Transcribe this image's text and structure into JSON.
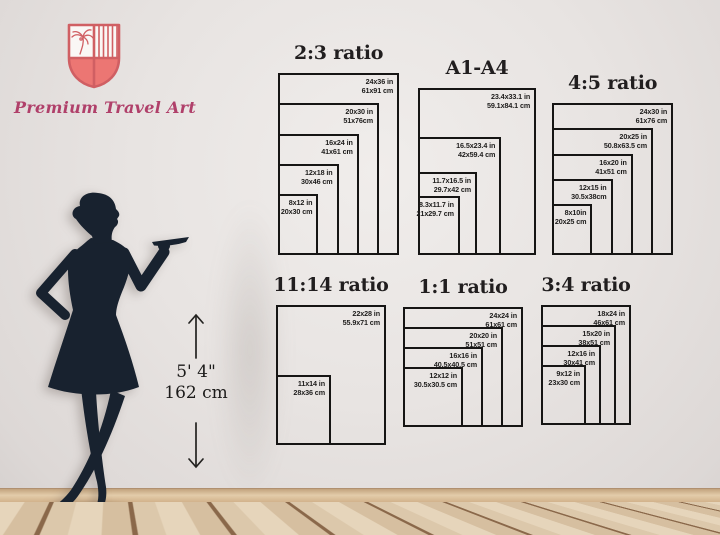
{
  "brand": {
    "name": "Premium Travel Art"
  },
  "height_marker": {
    "imperial": "5' 4\"",
    "metric": "162 cm"
  },
  "colors": {
    "shield_outline": "#d05f63",
    "shield_fill": "#ec7673",
    "brand_text": "#b0406a",
    "silhouette": "#18222f",
    "box_line": "#161514",
    "label_text": "#1d1c1b"
  },
  "charts": [
    {
      "id": "ratio-2-3",
      "title": "2:3 ratio",
      "sizes": [
        {
          "inches": "24x36 in",
          "cm": "61x91 cm",
          "w": 24,
          "h": 36
        },
        {
          "inches": "20x30 in",
          "cm": "51x76cm",
          "w": 20,
          "h": 30
        },
        {
          "inches": "16x24 in",
          "cm": "41x61 cm",
          "w": 16,
          "h": 24
        },
        {
          "inches": "12x18 in",
          "cm": "30x46 cm",
          "w": 12,
          "h": 18
        },
        {
          "inches": "8x12 in",
          "cm": "20x30 cm",
          "w": 8,
          "h": 12
        }
      ]
    },
    {
      "id": "a1-a4",
      "title": "A1-A4",
      "sizes": [
        {
          "inches": "23.4x33.1 in",
          "cm": "59.1x84.1 cm",
          "w": 23.4,
          "h": 33.1
        },
        {
          "inches": "16.5x23.4 in",
          "cm": "42x59.4 cm",
          "w": 16.5,
          "h": 23.4
        },
        {
          "inches": "11.7x16.5 in",
          "cm": "29.7x42 cm",
          "w": 11.7,
          "h": 16.5
        },
        {
          "inches": "8.3x11.7 in",
          "cm": "21x29.7 cm",
          "w": 8.3,
          "h": 11.7
        }
      ]
    },
    {
      "id": "ratio-4-5",
      "title": "4:5 ratio",
      "sizes": [
        {
          "inches": "24x30 in",
          "cm": "61x76 cm",
          "w": 24,
          "h": 30
        },
        {
          "inches": "20x25 in",
          "cm": "50.8x63.5 cm",
          "w": 20,
          "h": 25
        },
        {
          "inches": "16x20 in",
          "cm": "41x51 cm",
          "w": 16,
          "h": 20
        },
        {
          "inches": "12x15 in",
          "cm": "30.5x38cm",
          "w": 12,
          "h": 15
        },
        {
          "inches": "8x10in",
          "cm": "20x25 cm",
          "w": 8,
          "h": 10
        }
      ]
    },
    {
      "id": "ratio-11-14",
      "title": "11:14 ratio",
      "sizes": [
        {
          "inches": "22x28 in",
          "cm": "55.9x71 cm",
          "w": 22,
          "h": 28
        },
        {
          "inches": "11x14 in",
          "cm": "28x36 cm",
          "w": 11,
          "h": 14
        }
      ]
    },
    {
      "id": "ratio-1-1",
      "title": "1:1 ratio",
      "sizes": [
        {
          "inches": "24x24 in",
          "cm": "61x61 cm",
          "w": 24,
          "h": 24
        },
        {
          "inches": "20x20 in",
          "cm": "51x51 cm",
          "w": 20,
          "h": 20
        },
        {
          "inches": "16x16 in",
          "cm": "40.5x40.5 cm",
          "w": 16,
          "h": 16
        },
        {
          "inches": "12x12 in",
          "cm": "30.5x30.5 cm",
          "w": 12,
          "h": 12
        }
      ]
    },
    {
      "id": "ratio-3-4",
      "title": "3:4 ratio",
      "sizes": [
        {
          "inches": "18x24 in",
          "cm": "46x61 cm",
          "w": 18,
          "h": 24
        },
        {
          "inches": "15x20 in",
          "cm": "38x51 cm",
          "w": 15,
          "h": 20
        },
        {
          "inches": "12x16 in",
          "cm": "30x41 cm",
          "w": 12,
          "h": 16
        },
        {
          "inches": "9x12 in",
          "cm": "23x30 cm",
          "w": 9,
          "h": 12
        }
      ]
    }
  ]
}
